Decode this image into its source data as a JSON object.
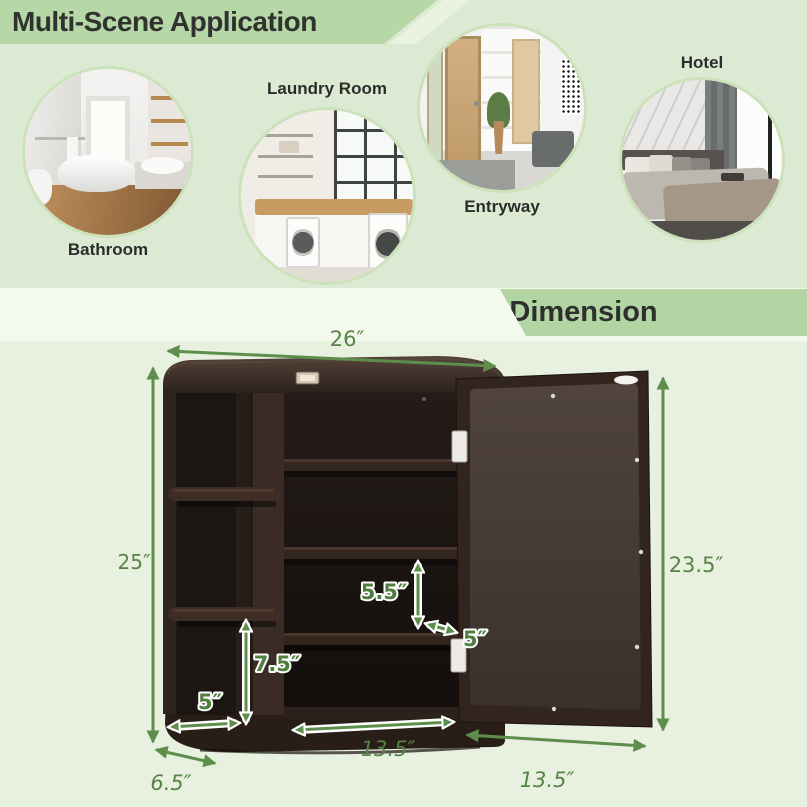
{
  "top_section": {
    "title": "Multi-Scene Application",
    "scenes": [
      {
        "id": "bathroom",
        "label": "Bathroom"
      },
      {
        "id": "laundry-room",
        "label": "Laundry Room"
      },
      {
        "id": "entryway",
        "label": "Entryway"
      },
      {
        "id": "hotel",
        "label": "Hotel"
      }
    ]
  },
  "dimension_section": {
    "title": "Dimension",
    "labels": {
      "overall_width": "26″",
      "overall_height": "25″",
      "door_height": "23.5″",
      "middle_shelf_gap": "5.5″",
      "lower_shelf_gap": "7.5″",
      "side_shelf_depth": "5″",
      "door_shelf_depth": "5″",
      "cabinet_bottom_width": "13.5″",
      "side_shelf_width": "6.5″",
      "door_width": "13.5″"
    }
  },
  "colors": {
    "banner_green": "#b6d7a6",
    "top_background": "#dcead3",
    "bottom_background": "#e8f1df",
    "divider_band": "#f4f9ee",
    "arrow_green": "#5e8e4b",
    "label_green": "#568447",
    "cabinet_brown": "#31251e",
    "title_text": "#30322f"
  }
}
